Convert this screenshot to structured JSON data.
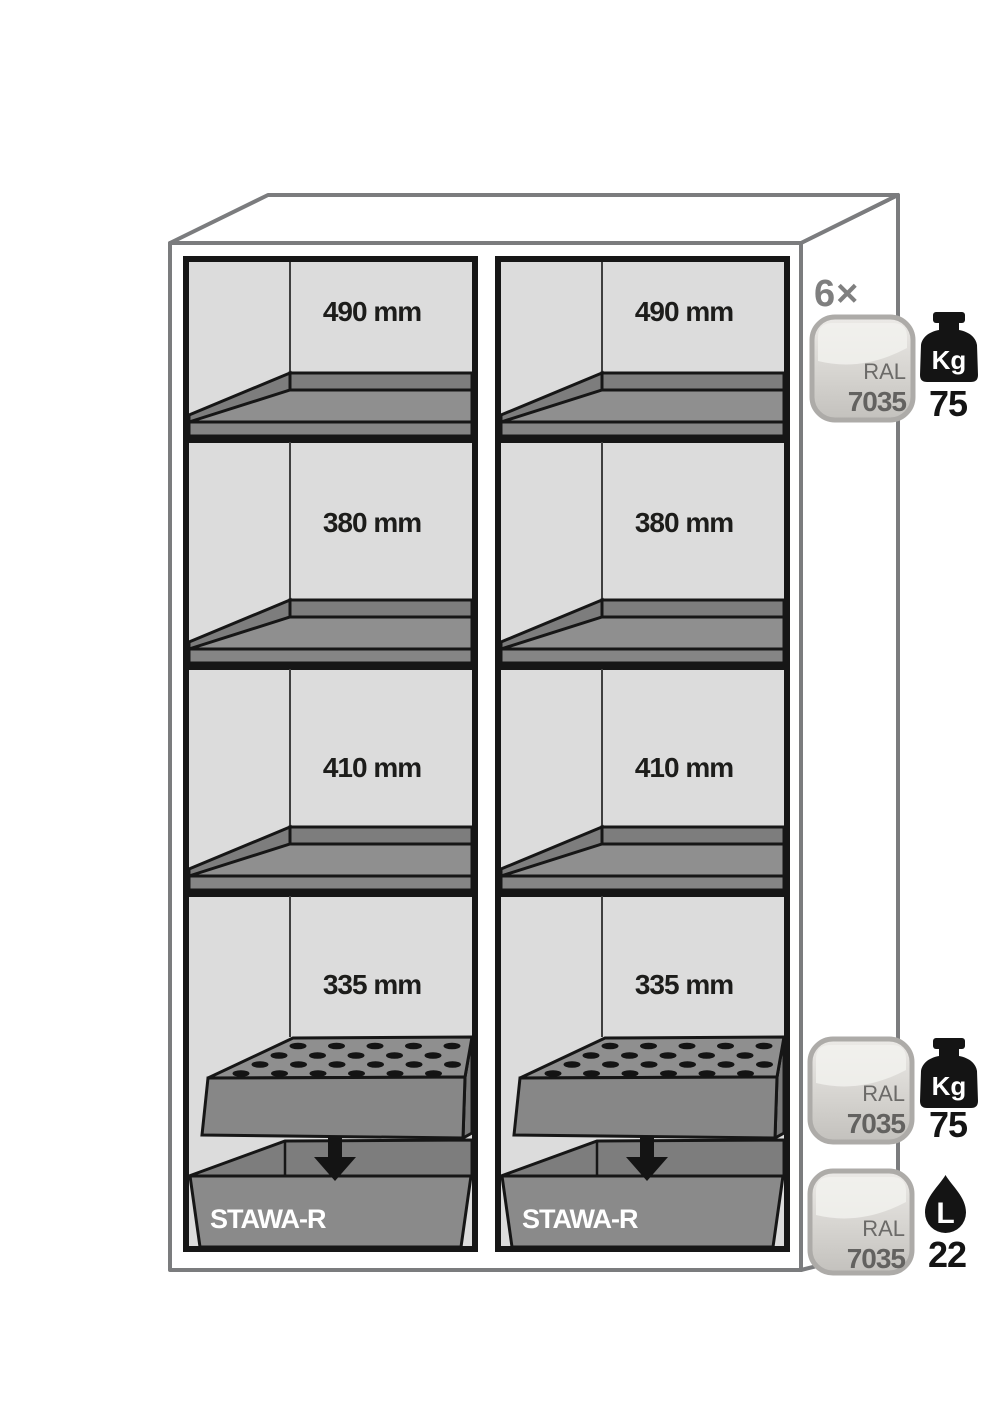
{
  "diagram": {
    "cabinet": {
      "compartments": [
        {
          "sections": [
            {
              "height_label": "490 mm"
            },
            {
              "height_label": "380 mm"
            },
            {
              "height_label": "410 mm"
            },
            {
              "height_label": "335 mm"
            }
          ],
          "sump_label": "STAWA-R"
        },
        {
          "sections": [
            {
              "height_label": "490 mm"
            },
            {
              "height_label": "380 mm"
            },
            {
              "height_label": "410 mm"
            },
            {
              "height_label": "335 mm"
            }
          ],
          "sump_label": "STAWA-R"
        }
      ]
    },
    "legend": {
      "shelf_count_label": "6×",
      "specs": [
        {
          "ral_line1": "RAL",
          "ral_line2": "7035",
          "unit": "Kg",
          "value": "75",
          "icon": "kg-weight-icon"
        },
        {
          "ral_line1": "RAL",
          "ral_line2": "7035",
          "unit": "Kg",
          "value": "75",
          "icon": "kg-weight-icon"
        },
        {
          "ral_line1": "RAL",
          "ral_line2": "7035",
          "unit": "L",
          "value": "22",
          "icon": "liter-drop-icon"
        }
      ]
    },
    "colors": {
      "interior_gray": "#dcdcdc",
      "shelf_gray": "#8f8f8f",
      "outline_black": "#161616",
      "cabinet_outline": "#7b7c7e",
      "badge_text": "#6b6a68",
      "muted_gray": "#7f7f7f"
    }
  }
}
